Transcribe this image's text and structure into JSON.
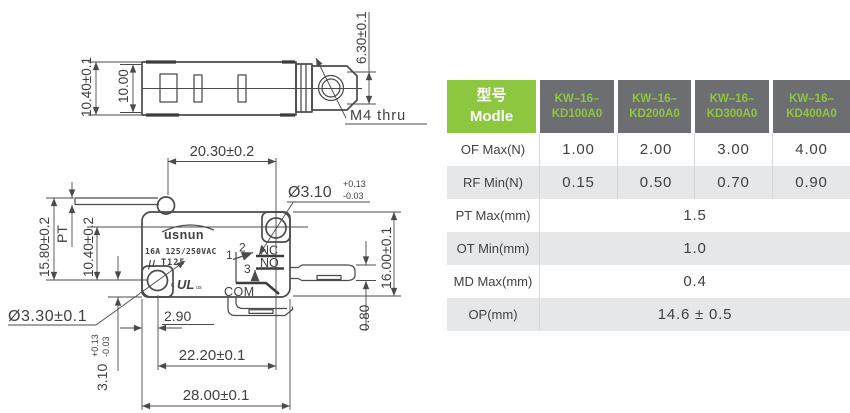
{
  "colors": {
    "accent_green": "#8DC63F",
    "header_gray": "#6D6E71",
    "row_alt_gray": "#E6E7E8",
    "text_dark": "#414042",
    "line_dark": "#4A4B4D"
  },
  "drawing": {
    "top_view": {
      "dim_width_outer": "10.40±0.1",
      "dim_width_inner": "10.00",
      "dim_end_height": "6.30±0.1",
      "hole_label": "M4 thru"
    },
    "front_view": {
      "dim_top_span": "20.30±0.2",
      "hole_top_dia": "Ø3.10",
      "hole_top_tol_plus": "+0.13",
      "hole_top_tol_minus": "-0.03",
      "dim_lever_height": "15.80±0.2",
      "pretravel_label": "PT",
      "dim_hole_vertical": "10.40±0.2",
      "hole_bottom_dia": "Ø3.30±0.1",
      "dim_hole_edge": "3.10",
      "hole_edge_tol_plus": "+0.13",
      "hole_edge_tol_minus": "-0.03",
      "dim_hole_offset": "2.90",
      "dim_hole_span": "22.20±0.1",
      "dim_body_width": "28.00±0.1",
      "dim_body_height": "16.00±0.1",
      "dim_terminal_thickness": "0.80",
      "brand": "usnun",
      "rating": "16A 125/250VAC",
      "mu": "µ",
      "temp_rating": "T125",
      "ul_c": "c",
      "ul_mark": "UL",
      "ul_us": "us",
      "terminal_1": "1",
      "terminal_2": "2",
      "terminal_3": "3",
      "contact_nc": "NC",
      "contact_no": "NO",
      "contact_com": "COM"
    }
  },
  "table": {
    "header": {
      "model_label_cn": "型号",
      "model_label_en": "Modle",
      "models": [
        {
          "line1": "KW–16–",
          "line2": "KD100A0"
        },
        {
          "line1": "KW–16–",
          "line2": "KD200A0"
        },
        {
          "line1": "KW–16–",
          "line2": "KD300A0"
        },
        {
          "line1": "KW–16–",
          "line2": "KD400A0"
        }
      ]
    },
    "rows": [
      {
        "label": "OF Max(N)",
        "values": [
          "1.00",
          "2.00",
          "3.00",
          "4.00"
        ]
      },
      {
        "label": "RF Min(N)",
        "values": [
          "0.15",
          "0.50",
          "0.70",
          "0.90"
        ]
      },
      {
        "label": "PT Max(mm)",
        "value": "1.5"
      },
      {
        "label": "OT Min(mm)",
        "value": "1.0"
      },
      {
        "label": "MD Max(mm)",
        "value": "0.4"
      },
      {
        "label": "OP(mm)",
        "value": "14.6 ± 0.5"
      }
    ]
  }
}
